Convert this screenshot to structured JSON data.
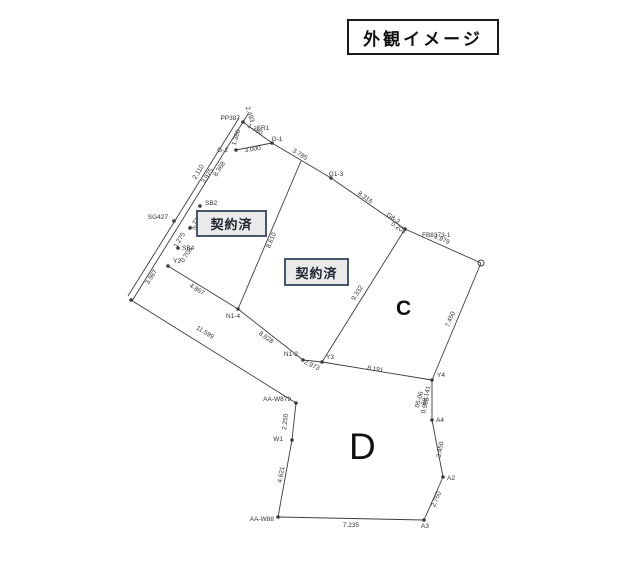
{
  "title": "外観イメージ",
  "plots": {
    "plot1_label": "契約済",
    "plot2_label": "契約済",
    "plot_c_label": "C",
    "plot_d_label": "D"
  },
  "diagram": {
    "stroke_color": "#3c3c3c",
    "label_color": "#333333",
    "lines": [
      [
        239,
        118,
        128,
        296
      ],
      [
        243,
        122,
        132,
        301
      ],
      [
        243,
        122,
        272,
        143
      ],
      [
        236,
        150,
        272,
        143
      ],
      [
        272,
        143,
        331,
        178
      ],
      [
        331,
        178,
        405,
        229
      ],
      [
        405,
        229,
        481,
        263
      ],
      [
        481,
        263,
        432,
        380
      ],
      [
        301,
        161,
        238,
        309
      ],
      [
        405,
        229,
        322,
        362
      ],
      [
        168,
        266,
        238,
        309
      ],
      [
        238,
        309,
        303,
        360
      ],
      [
        303,
        360,
        322,
        362
      ],
      [
        322,
        362,
        432,
        380
      ],
      [
        131,
        300,
        296,
        403
      ],
      [
        296,
        403,
        292,
        440
      ],
      [
        292,
        440,
        278,
        517
      ],
      [
        278,
        517,
        424,
        520
      ],
      [
        424,
        520,
        443,
        477
      ],
      [
        443,
        477,
        432,
        420
      ],
      [
        432,
        420,
        432,
        380
      ],
      [
        243,
        122,
        248,
        114
      ]
    ],
    "points": [
      [
        243,
        122
      ],
      [
        236,
        150
      ],
      [
        272,
        143
      ],
      [
        331,
        178
      ],
      [
        405,
        229
      ],
      [
        200,
        206
      ],
      [
        190,
        228
      ],
      [
        178,
        248
      ],
      [
        168,
        266
      ],
      [
        238,
        309
      ],
      [
        303,
        360
      ],
      [
        322,
        362
      ],
      [
        432,
        380
      ],
      [
        432,
        420
      ],
      [
        443,
        477
      ],
      [
        424,
        520
      ],
      [
        278,
        517
      ],
      [
        292,
        440
      ],
      [
        296,
        403
      ],
      [
        131,
        300
      ],
      [
        174,
        221
      ]
    ],
    "circle_points": [
      [
        481,
        263
      ]
    ],
    "labels": [
      {
        "t": "PP387",
        "x": 240,
        "y": 120,
        "a": "end"
      },
      {
        "t": "2.493",
        "x": 248,
        "y": 115,
        "r": 72
      },
      {
        "t": "SR1",
        "x": 263,
        "y": 130
      },
      {
        "t": "1.380",
        "x": 254,
        "y": 131,
        "r": 33
      },
      {
        "t": "1.380",
        "x": 238,
        "y": 138,
        "r": -72
      },
      {
        "t": "G-2",
        "x": 228,
        "y": 152,
        "a": "end"
      },
      {
        "t": "3.000",
        "x": 253,
        "y": 151,
        "r": -10
      },
      {
        "t": "G-1",
        "x": 277,
        "y": 141
      },
      {
        "t": "3.785",
        "x": 299,
        "y": 156,
        "r": 31
      },
      {
        "t": "G1-3",
        "x": 336,
        "y": 176
      },
      {
        "t": "8.316",
        "x": 364,
        "y": 199,
        "r": 35
      },
      {
        "t": "G8-3",
        "x": 398,
        "y": 224,
        "r": 35,
        "a": "end"
      },
      {
        "t": "0.203",
        "x": 404,
        "y": 234,
        "r": 35,
        "a": "end"
      },
      {
        "t": "FB8373-1",
        "x": 422,
        "y": 237,
        "a": "start"
      },
      {
        "t": "1.979",
        "x": 441,
        "y": 241,
        "r": 24
      },
      {
        "t": "7.450",
        "x": 452,
        "y": 320,
        "r": -67
      },
      {
        "t": "9.332",
        "x": 359,
        "y": 294,
        "r": -58
      },
      {
        "t": "8.610",
        "x": 273,
        "y": 241,
        "r": -67
      },
      {
        "t": "2.110",
        "x": 200,
        "y": 173,
        "r": -58
      },
      {
        "t": "3.975",
        "x": 209,
        "y": 177,
        "r": -58
      },
      {
        "t": "8.368",
        "x": 221,
        "y": 170,
        "r": -58
      },
      {
        "t": "SG427",
        "x": 168,
        "y": 219,
        "a": "end"
      },
      {
        "t": "SB2",
        "x": 205,
        "y": 205,
        "a": "start"
      },
      {
        "t": "1.718",
        "x": 197,
        "y": 223,
        "r": -58
      },
      {
        "t": "SB3",
        "x": 194,
        "y": 230,
        "a": "start"
      },
      {
        "t": "1.275",
        "x": 181,
        "y": 241,
        "r": -58
      },
      {
        "t": "SB4",
        "x": 182,
        "y": 250,
        "a": "start"
      },
      {
        "t": "0.708",
        "x": 188,
        "y": 256,
        "r": -58
      },
      {
        "t": "3.967",
        "x": 153,
        "y": 278,
        "r": -58
      },
      {
        "t": "Y2",
        "x": 173,
        "y": 263,
        "a": "start"
      },
      {
        "t": "4.867",
        "x": 196,
        "y": 291,
        "r": 31
      },
      {
        "t": "N1-4",
        "x": 226,
        "y": 318,
        "a": "start"
      },
      {
        "t": "8.928",
        "x": 265,
        "y": 339,
        "r": 36
      },
      {
        "t": "N1-2",
        "x": 298,
        "y": 356,
        "a": "end"
      },
      {
        "t": "2.973",
        "x": 311,
        "y": 367,
        "r": 25
      },
      {
        "t": "Y3",
        "x": 326,
        "y": 359,
        "a": "start"
      },
      {
        "t": "8.191",
        "x": 375,
        "y": 371,
        "r": 9
      },
      {
        "t": "Y4",
        "x": 437,
        "y": 377,
        "a": "start"
      },
      {
        "t": "69.141",
        "x": 428,
        "y": 396,
        "r": -75
      },
      {
        "t": "05-06",
        "x": 421,
        "y": 400,
        "r": -75
      },
      {
        "t": "0.985",
        "x": 427,
        "y": 406,
        "r": -75
      },
      {
        "t": "A4",
        "x": 436,
        "y": 422,
        "a": "start"
      },
      {
        "t": "3.450",
        "x": 442,
        "y": 450,
        "r": -79
      },
      {
        "t": "A2",
        "x": 447,
        "y": 480,
        "a": "start"
      },
      {
        "t": "2.750",
        "x": 438,
        "y": 500,
        "r": -66
      },
      {
        "t": "A3",
        "x": 421,
        "y": 528,
        "a": "start"
      },
      {
        "t": "7.235",
        "x": 351,
        "y": 527
      },
      {
        "t": "AA-W88",
        "x": 274,
        "y": 521,
        "a": "end"
      },
      {
        "t": "4.621",
        "x": 283,
        "y": 475,
        "r": -80
      },
      {
        "t": "W1",
        "x": 283,
        "y": 441,
        "a": "end"
      },
      {
        "t": "2.250",
        "x": 287,
        "y": 422,
        "r": -84
      },
      {
        "t": "AA-W879",
        "x": 291,
        "y": 401,
        "a": "end"
      },
      {
        "t": "11.599",
        "x": 204,
        "y": 334,
        "r": 32
      }
    ]
  }
}
